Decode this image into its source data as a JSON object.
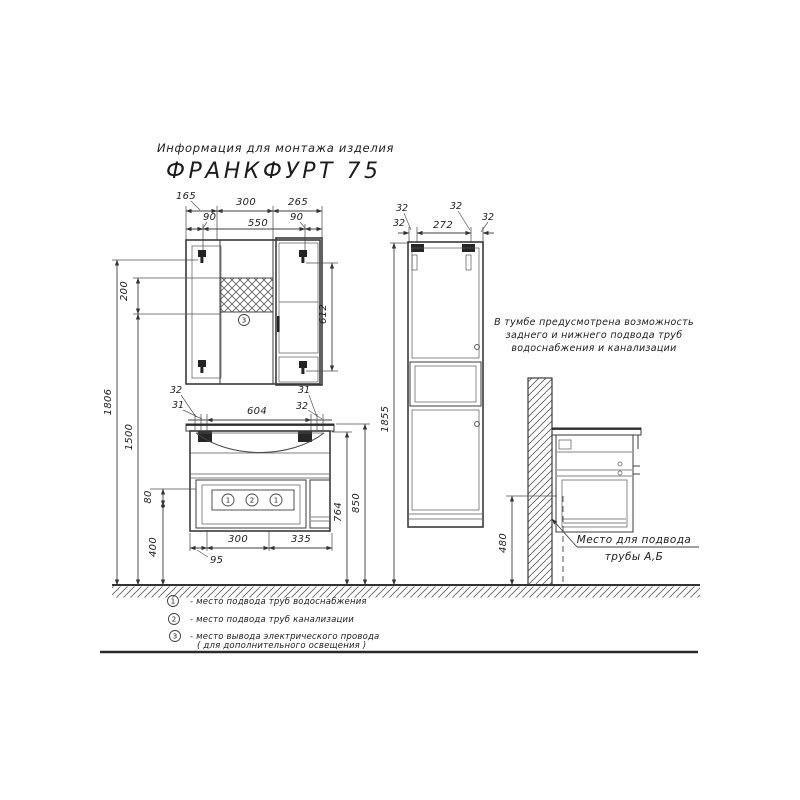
{
  "header": {
    "subtitle": "Информация для монтажа изделия",
    "title": "ФРАНКФУРТ 75"
  },
  "colors": {
    "line": "#3a3a3a",
    "text": "#1c1c1c",
    "background": "#ffffff"
  },
  "mirror_cabinet": {
    "dims": {
      "w_left": "165",
      "w_mid": "300",
      "w_right": "265",
      "plug_left": "90",
      "w_inner": "550",
      "plug_right": "90",
      "lamp_zone": "200",
      "door_h": "612",
      "h_total": "1806",
      "h_lamp": "1500"
    },
    "marker": "3"
  },
  "vanity": {
    "dims": {
      "bracket_l1": "32",
      "bracket_l2": "31",
      "basin_w": "604",
      "bracket_r1": "31",
      "bracket_r2": "32",
      "socket_h": "80",
      "h_bottom": "400",
      "conn_w": "300",
      "right_w": "335",
      "offset": "95",
      "body_h": "764",
      "top_h": "850"
    },
    "markers": [
      "1",
      "2",
      "1"
    ]
  },
  "tall_cabinet": {
    "dims": {
      "b1": "32",
      "b2": "32",
      "span": "272",
      "b3": "32",
      "b4": "32",
      "h": "1855"
    }
  },
  "side_view": {
    "note": [
      "В тумбе предусмотрена возможность",
      "заднего и нижнего подвода труб",
      "водоснабжения и канализации"
    ],
    "dim_h": "480",
    "callout": [
      "Место для подвода",
      "трубы А,Б"
    ]
  },
  "legend": {
    "items": [
      {
        "n": "1",
        "text": "- место подвода труб водоснабжения",
        "text2": ""
      },
      {
        "n": "2",
        "text": "- место подвода труб канализации",
        "text2": ""
      },
      {
        "n": "3",
        "text": "- место вывода электрического провода",
        "text2": "( для дополнительного освещения )"
      }
    ]
  }
}
